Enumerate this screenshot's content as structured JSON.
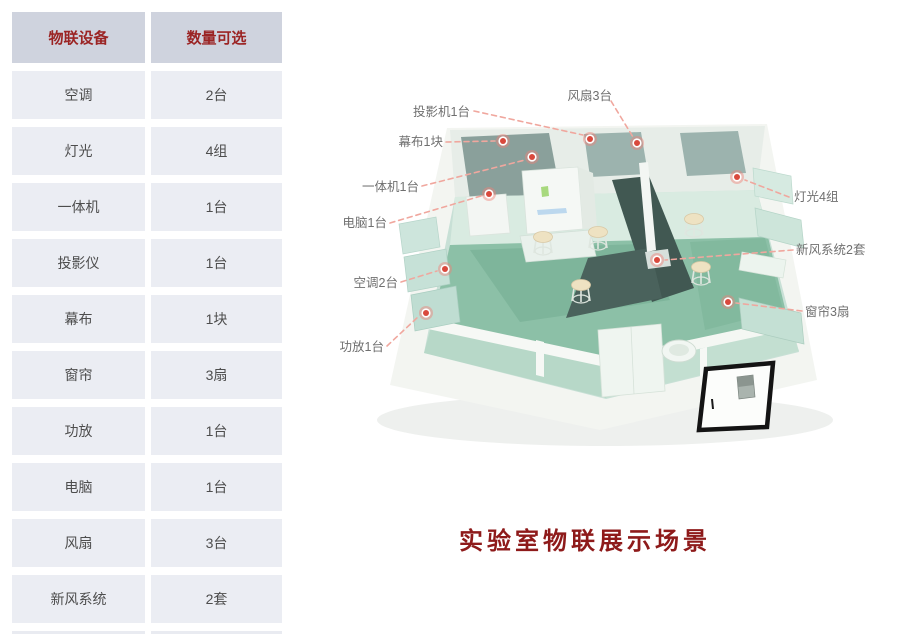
{
  "table": {
    "headers": [
      "物联设备",
      "数量可选"
    ],
    "rows": [
      [
        "空调",
        "2台"
      ],
      [
        "灯光",
        "4组"
      ],
      [
        "一体机",
        "1台"
      ],
      [
        "投影仪",
        "1台"
      ],
      [
        "幕布",
        "1块"
      ],
      [
        "窗帘",
        "3扇"
      ],
      [
        "功放",
        "1台"
      ],
      [
        "电脑",
        "1台"
      ],
      [
        "风扇",
        "3台"
      ],
      [
        "新风系统",
        "2套"
      ]
    ]
  },
  "diagram": {
    "caption": "实验室物联展示场景",
    "labels": {
      "projector": "投影机1台",
      "fan": "风扇3台",
      "screen": "幕布1块",
      "all_in_one": "一体机1台",
      "computer": "电脑1台",
      "air_conditioner": "空调2台",
      "amplifier": "功放1台",
      "lighting": "灯光4组",
      "fresh_air": "新风系统2套",
      "curtain": "窗帘3扇"
    }
  },
  "colors": {
    "header-bg": "#cfd3de",
    "header-text": "#9b2424",
    "row-bg": "#ebedf3",
    "row-text": "#4d4d4d",
    "caption-text": "#8e1a1a",
    "marker-red": "#d9493d",
    "leader-line": "#f0a79e",
    "label-text": "#6f6f6f"
  }
}
